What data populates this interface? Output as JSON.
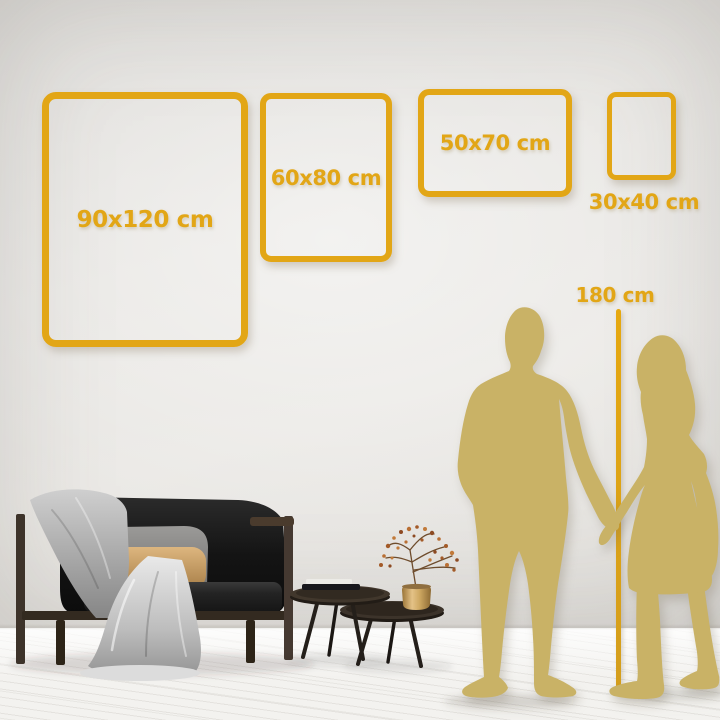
{
  "palette": {
    "accent_gold": "#E2A616",
    "silhouette_gold": "#C9B266"
  },
  "frames": [
    {
      "label": "90x120 cm"
    },
    {
      "label": "60x80 cm"
    },
    {
      "label": "50x70 cm"
    },
    {
      "label": "30x40 cm"
    }
  ],
  "height_marker": {
    "label": "180 cm"
  }
}
